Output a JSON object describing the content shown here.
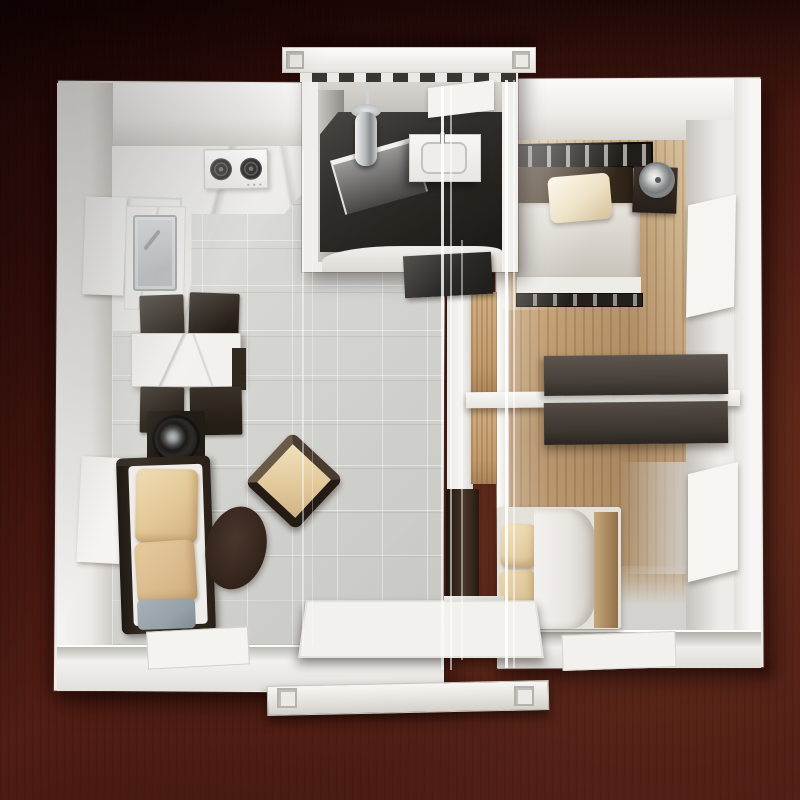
{
  "scene": {
    "type": "photograph",
    "subject": "Miniature architectural model of an expandable container house interior, viewed top-down",
    "surface": "dark mahogany wood tabletop",
    "model_material": "white PVC walls with clear acrylic cover sheets"
  },
  "palette": {
    "table_dark": "#260807",
    "table_mid": "#4f1d13",
    "table_light": "#6b3423",
    "model_white": "#efede9",
    "wall_bright": "#fbfaf9",
    "wall_shadow": "#d5d2cd",
    "tile_floor": "#d4d4d0",
    "marble_white": "#edebe7",
    "wood_floor": "#c5a478",
    "wood_door": "#c29a6c",
    "furniture_black": "#241d16",
    "furniture_brown": "#46403a",
    "headboard_brown": "#4a3a2c",
    "bath_floor": "#26231f",
    "cushion_beige": "#e3c795",
    "cushion_gray": "#96a1a8",
    "bedding_white": "#efede9",
    "duvet_gray": "#d4cfc7",
    "window_dark": "#4a3b30",
    "window_red": "#7a4134",
    "window_green": "#49523a",
    "metal_silver": "#b4b8ba",
    "rug_brown": "#37271e"
  },
  "rooms": {
    "living_kitchen": {
      "label": "Open living room and kitchen, left wing",
      "furniture": [
        "gas stove with 2 burners",
        "wire shelf rack",
        "marble sink counter with steel basin",
        "marble dining table",
        "4 dark dining chairs",
        "round speaker on dark stand",
        "sofa with two beige pillows and one gray cushion",
        "dark oval rug",
        "diagonal beige accent armchair",
        "2 dark wall windows",
        "folded dark floor glass panels"
      ]
    },
    "bathroom": {
      "label": "Bathroom module, top center",
      "furniture": [
        "chrome shower column",
        "glass shower screen",
        "white vanity with basin",
        "high two-pane window",
        "dark tiled floor",
        "dark door mat"
      ]
    },
    "bedroom_1": {
      "label": "Bedroom 1, top right",
      "furniture": [
        "double bed with black slatted rail",
        "brown headboard",
        "cream pillow",
        "gray duvet",
        "corner nightstand",
        "silver table fan",
        "red-tinted two-pane wall window"
      ]
    },
    "bedroom_2": {
      "label": "Bedroom 2, bottom right",
      "furniture": [
        "bed with rolled white duvet",
        "two beige pillows",
        "light wood footboard",
        "dark TV panel",
        "red-tinted two-pane wall window",
        "green glazed floor panel"
      ]
    },
    "wardrobe_wall": {
      "label": "Back-to-back dark wardrobes on central divider wall"
    },
    "porch": {
      "label": "Entry porch, bottom center",
      "furniture": [
        "glazed door panel grid",
        "white container base rail",
        "corner castings"
      ]
    }
  },
  "container_details": {
    "top_rail_castings": 2,
    "bottom_rail_castings": 2,
    "window_panes_per_unit": 2,
    "acrylic_reflection_lines": 7
  }
}
